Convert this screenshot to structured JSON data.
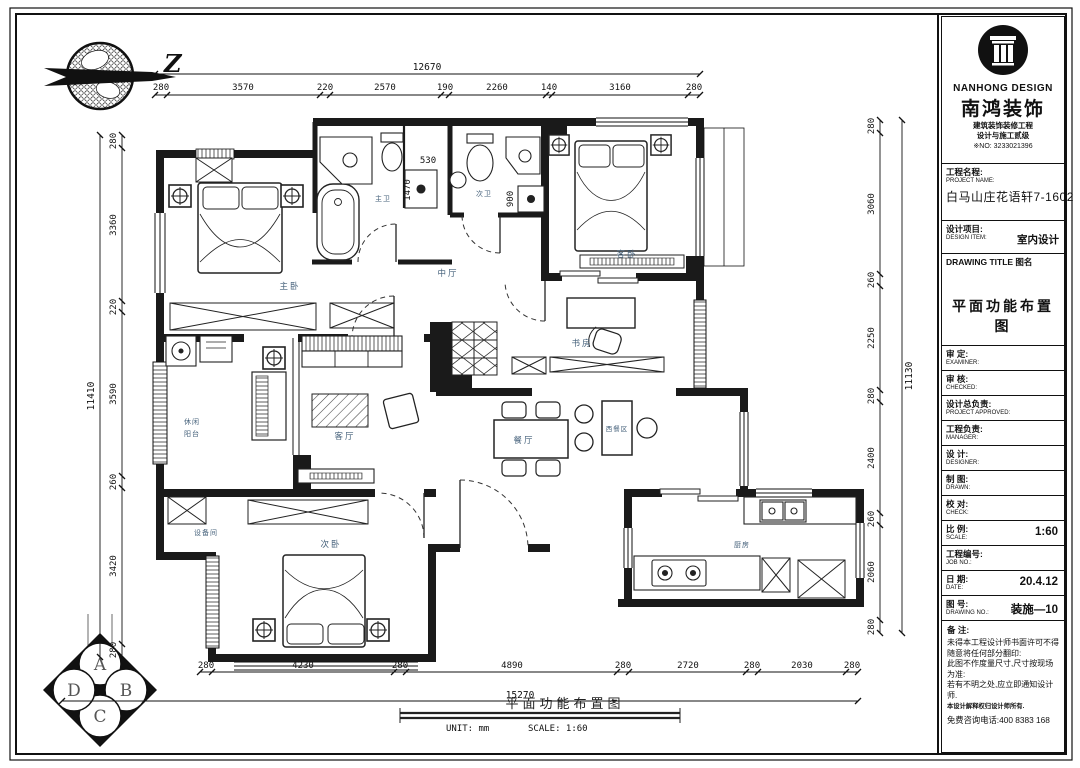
{
  "north": {
    "label": "Z"
  },
  "badge": {
    "top": "A",
    "right": "B",
    "bottom": "C",
    "left": "D"
  },
  "brand": {
    "en": "NANHONG DESIGN",
    "cn": "南鸿装饰",
    "line1": "建筑装饰装修工程",
    "line2": "设计与施工贰级",
    "cert_no": "※NO: 3233021396"
  },
  "title_block": {
    "project_label_cn": "工程名程:",
    "project_label_en": "PROJECT NAME:",
    "project_value": "白马山庄花语轩7-1602",
    "design_label_cn": "设计项目:",
    "design_label_en": "DESIGN ITEM:",
    "design_value": "室内设计",
    "drawing_title_label": "DRAWING TITLE 图名",
    "drawing_title": "平面功能布置图",
    "rows": [
      {
        "cn": "审  定:",
        "en": "EXAMINER:",
        "value": ""
      },
      {
        "cn": "审  核:",
        "en": "CHECKED:",
        "value": ""
      },
      {
        "cn": "设计总负责:",
        "en": "PROJECT APPROVED:",
        "value": ""
      },
      {
        "cn": "工程负责:",
        "en": "MANAGER:",
        "value": ""
      },
      {
        "cn": "设  计:",
        "en": "DESIGNER:",
        "value": ""
      },
      {
        "cn": "制  图:",
        "en": "DRAWN:",
        "value": ""
      },
      {
        "cn": "校  对:",
        "en": "CHECK:",
        "value": ""
      },
      {
        "cn": "比  例:",
        "en": "SCALE:",
        "value": "1:60"
      },
      {
        "cn": "工程编号:",
        "en": "JOB NO.:",
        "value": ""
      },
      {
        "cn": "日  期:",
        "en": "DATE:",
        "value": "20.4.12"
      },
      {
        "cn": "图  号:",
        "en": "DRAWING NO.:",
        "value": "装施—10"
      }
    ],
    "notes_label": "备  注:",
    "notes": [
      "未得本工程设计师书面许可不得",
      "随意将任何部分翻印:",
      "此图不作度量尺寸,尺寸按现场",
      "为准:",
      "若有不明之处,应立即通知设计",
      "师.",
      "本设计解释权归设计师所有.",
      "免费咨询电话:400 8383 168"
    ]
  },
  "rooms": {
    "master_bedroom": "主卧",
    "master_bath": "主卫",
    "second_bath": "次卫",
    "middle_hall": "中厅",
    "guest_bedroom": "客卧",
    "study": "书房",
    "balcony_line1": "休闲",
    "balcony_line2": "阳台",
    "living_room": "客厅",
    "dining_room": "餐厅",
    "western_dining": "西餐区",
    "equipment_room": "设备间",
    "second_bedroom": "次卧",
    "kitchen": "厨房"
  },
  "dims": {
    "top_total": "12670",
    "top": [
      "280",
      "3570",
      "220",
      "2570",
      "190",
      "2260",
      "140",
      "3160",
      "280"
    ],
    "left_total": "11410",
    "left": [
      "280",
      "3360",
      "220",
      "3590",
      "260",
      "3420",
      "280"
    ],
    "right_total": "11130",
    "right": [
      "280",
      "3060",
      "260",
      "2250",
      "280",
      "2400",
      "260",
      "2060",
      "280"
    ],
    "bottom_total": "15270",
    "bottom": [
      "280",
      "4230",
      "280",
      "4890",
      "280",
      "2720",
      "280",
      "2030",
      "280"
    ],
    "inner": [
      "1470",
      "530",
      "900"
    ]
  },
  "caption": {
    "title": "平面功能布置图",
    "unit": "UNIT: mm",
    "scale": "SCALE: 1:60"
  }
}
